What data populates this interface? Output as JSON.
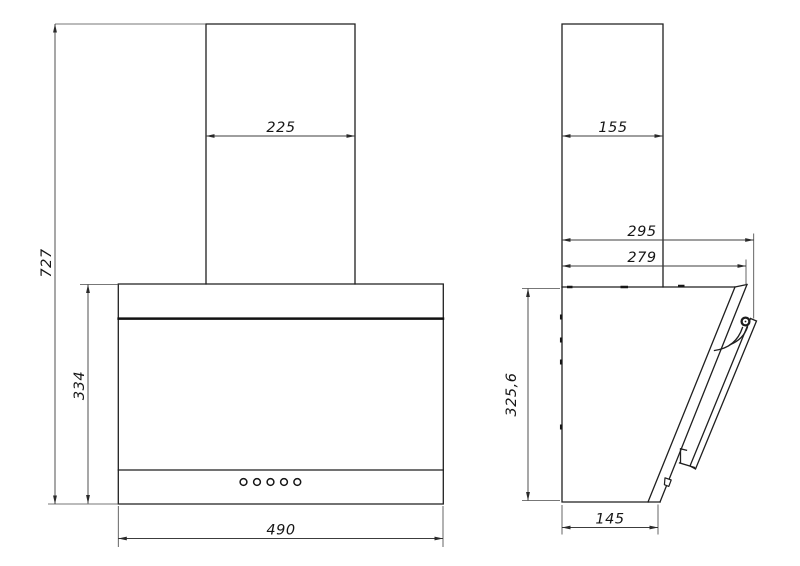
{
  "front_view": {
    "dim_overall_height": "727",
    "dim_chimney_width": "225",
    "dim_body_height": "334",
    "dim_body_width": "490",
    "control_buttons": 5
  },
  "side_view": {
    "dim_chimney_depth": "155",
    "dim_overall_depth": "295",
    "dim_glass_panel_depth": "279",
    "dim_body_height": "325,6",
    "dim_base_depth": "145"
  },
  "style": {
    "line_color": "#1f1f1f",
    "dim_color": "#3c3c3c",
    "background": "#ffffff"
  }
}
